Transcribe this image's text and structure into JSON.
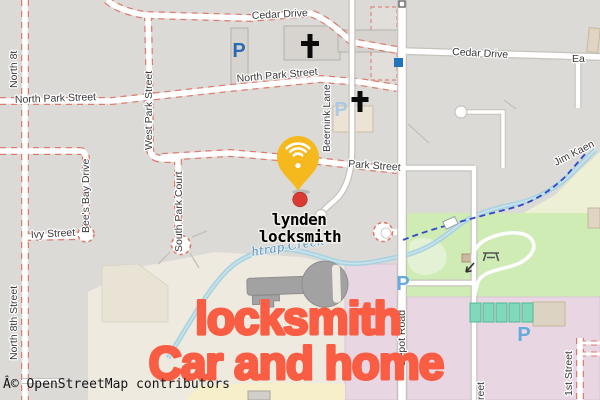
{
  "map": {
    "attribution": "Â© OpenStreetMap contributors",
    "streets": {
      "cedar_drive_west": "Cedar Drive",
      "cedar_drive_east": "Cedar Drive",
      "east_partial": "Ea",
      "north_park_center": "North Park Street",
      "north_park_west": "North Park Street",
      "north_8th_top": "North 8t",
      "north_8th_bottom": "North 8th Street",
      "west_park": "West Park Street",
      "bees_bay": "Bee's Bay Drive",
      "south_park_court": "South Park Court",
      "ivy": "Ivy Street",
      "beernink": "Beernink Lane",
      "park": "Park Street",
      "depot": "Depot Road",
      "first_street": "1st Street",
      "street_partial": "reet",
      "jim_kaen_trail": "Jim Kaen"
    },
    "water": {
      "creek_label": "htrap Creek"
    },
    "icons": {
      "parking": "P"
    }
  },
  "overlay": {
    "place_line1": "lynden",
    "place_line2": "locksmith",
    "headline_line1": "locksmith",
    "headline_line2": "Car and home"
  },
  "colors": {
    "headline": "#f95d43",
    "pin": "#f5b91e",
    "marker": "#d93a33",
    "parking_blue": "#2a6cb3",
    "parking_blue_light": "#a9c9e7",
    "water": "#aad3df",
    "park_green": "#cfecb5",
    "industrial": "#e8d7e3",
    "farmland_yellow": "#f6efc9",
    "trail_blue": "#3047c8",
    "road_dash_red": "#dd7b6e"
  }
}
